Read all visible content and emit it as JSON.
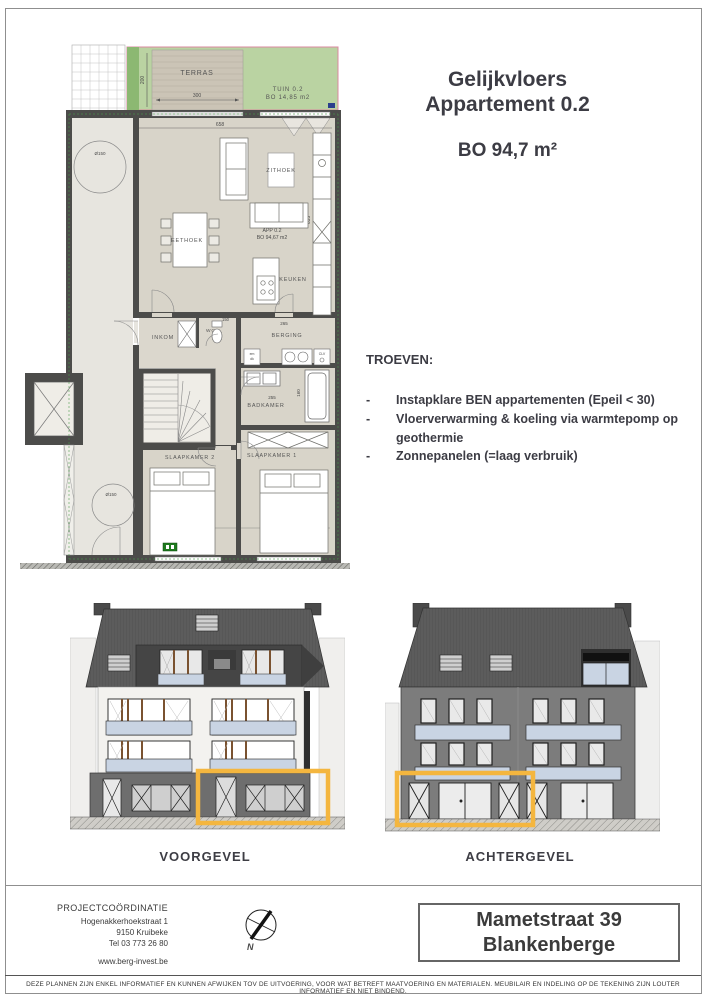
{
  "title": {
    "line1": "Gelijkvloers",
    "line2": "Appartement 0.2",
    "area": "BO 94,7 m²"
  },
  "troeven": {
    "heading": "TROEVEN:",
    "bullet": "-",
    "items": [
      "Instapklare BEN appartementen (Epeil < 30)",
      "Vloerverwarming & koeling via warmtepomp op geothermie",
      "Zonnepanelen (=laag verbruik)"
    ]
  },
  "floorplan": {
    "terras": "TERRAS",
    "tuin_line1": "TUIN 0.2",
    "tuin_line2": "BO 14,85 m2",
    "app_line1": "APP 0.2",
    "app_line2": "BO 94,67 m2",
    "rooms": {
      "zithoek": "ZITHOEK",
      "eethoek": "EETHOEK",
      "keuken": "KEUKEN",
      "inkom": "INKOM",
      "wc": "WC",
      "berging": "BERGING",
      "badkamer": "BADKAMER",
      "slaapkamer1": "SLAAPKAMER 1",
      "slaapkamer2": "SLAAPKAMER 2"
    },
    "dims": {
      "terras_w": "300",
      "terras_d": "200",
      "living_w": "658",
      "living_d": "635",
      "wc": "150",
      "berging": "265",
      "badkamer_w": "255",
      "badkamer_d": "160",
      "sk2_d": "330",
      "sk2_w": "300",
      "sk1_w": "284",
      "sk1_d": "430"
    },
    "circle": "Ø150",
    "labels": {
      "em": "em",
      "dk": "dk",
      "clv": "CLV"
    }
  },
  "elevations": {
    "front": "VOORGEVEL",
    "back": "ACHTERGEVEL"
  },
  "footer": {
    "coordination": {
      "heading": "PROJECTCOÖRDINATIE",
      "line1": "Hogenakkerhoekstraat 1",
      "line2": "9150 Kruibeke",
      "line3": "Tel 03 773 26 80",
      "website": "www.berg-invest.be"
    },
    "compass_n": "N",
    "address": {
      "line1": "Mametstraat 39",
      "line2": "Blankenberge"
    },
    "disclaimer": "DEZE PLANNEN ZIJN ENKEL INFORMATIEF EN KUNNEN AFWIJKEN TOV DE UITVOERING, VOOR WAT BETREFT MAATVOERING EN MATERIALEN. MEUBILAIR EN INDELING OP DE TEKENING ZIJN LOUTER INFORMATIEF EN NIET BINDEND."
  },
  "colors": {
    "accent_orange": "#F4B63F",
    "garden_green": "#BAD3A2",
    "boundary_pink": "#DB8AA0",
    "wall_gray": "#4C4C4A",
    "roof_gray": "#575757",
    "glass_blue": "#C9D4E3"
  }
}
